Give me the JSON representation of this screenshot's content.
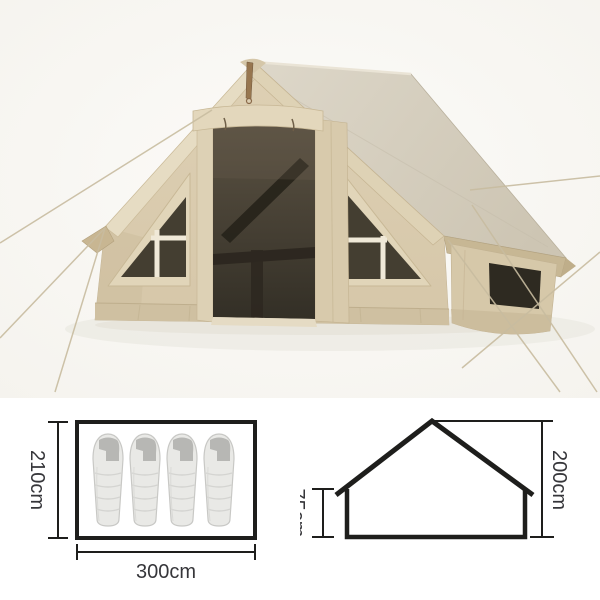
{
  "page": {
    "background_color": "#ffffff"
  },
  "product_photo": {
    "alt": "Beige inflatable cabin tent with large mesh door, two triangular grid windows, side window, roof awning and guy ropes",
    "colors": {
      "fabric": "#dacbae",
      "fabric_light": "#e6dcc3",
      "fabric_shadow": "#c8b692",
      "roof": "#d5cdbc",
      "mesh": "#443e31",
      "mesh_dark": "#2e2a21",
      "window_frame": "#f0e9d8",
      "rope": "#c8bca0",
      "ground_shadow": "#eae8e0"
    }
  },
  "floor_plan_diagram": {
    "depth_label": "210cm",
    "width_label": "300cm",
    "sleeping_bag_count": 4,
    "line_color": "#1e1e1c",
    "label_color": "#36363a",
    "sleeping_bag_fill": "#e9e9e6",
    "sleeping_bag_hood": "#b7b7b4"
  },
  "side_profile_diagram": {
    "wall_height_label": "75cm",
    "total_height_label": "200cm",
    "line_color": "#1e1e1c",
    "label_color": "#36363a"
  }
}
